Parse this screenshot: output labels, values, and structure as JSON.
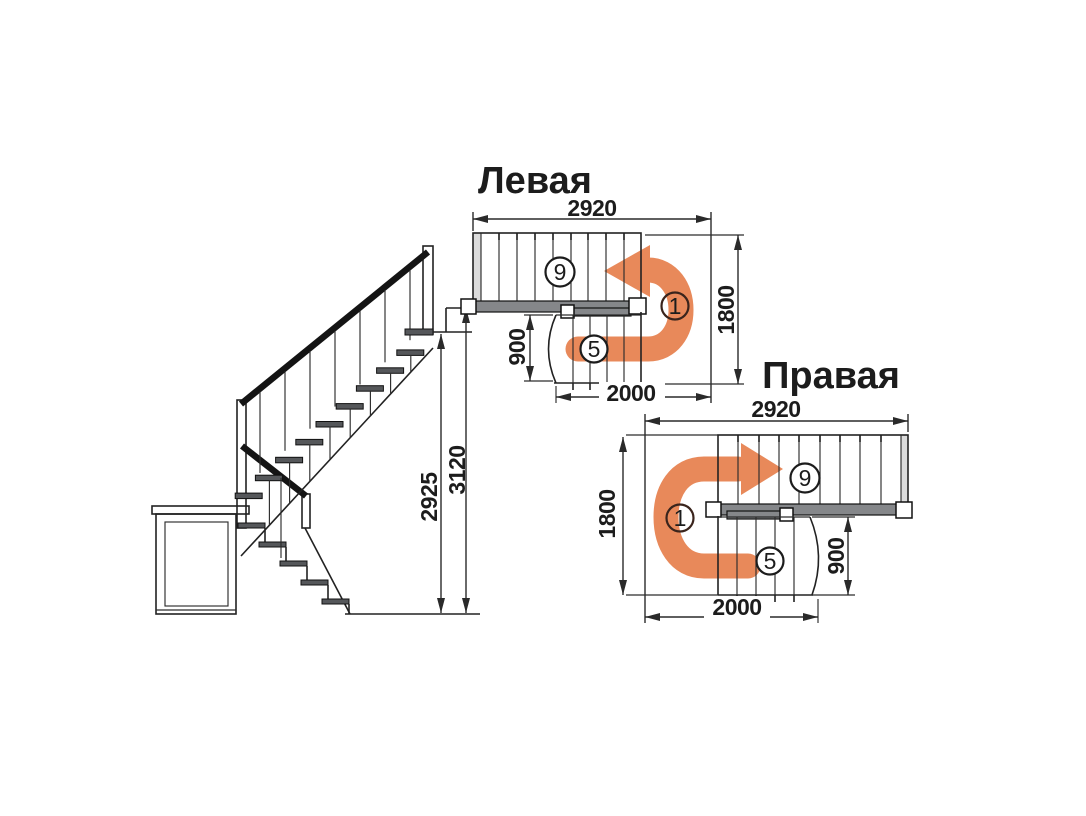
{
  "left_plan": {
    "title": "Левая",
    "dim_top": "2920",
    "dim_side": "1800",
    "dim_flight_width": "900",
    "dim_bottom": "2000",
    "label_upper_flight": "9",
    "label_lower_flight": "5",
    "label_start": "1"
  },
  "right_plan": {
    "title": "Правая",
    "dim_top": "2920",
    "dim_side": "1800",
    "dim_flight_width": "900",
    "dim_bottom": "2000",
    "label_upper_flight": "9",
    "label_lower_flight": "5",
    "label_start": "1"
  },
  "elevation": {
    "dim_height_to_floor": "2925",
    "dim_total_height": "3120"
  },
  "colors": {
    "arrow": "#e8895a",
    "line": "#222222",
    "digit_start": "#6e2c1c"
  }
}
